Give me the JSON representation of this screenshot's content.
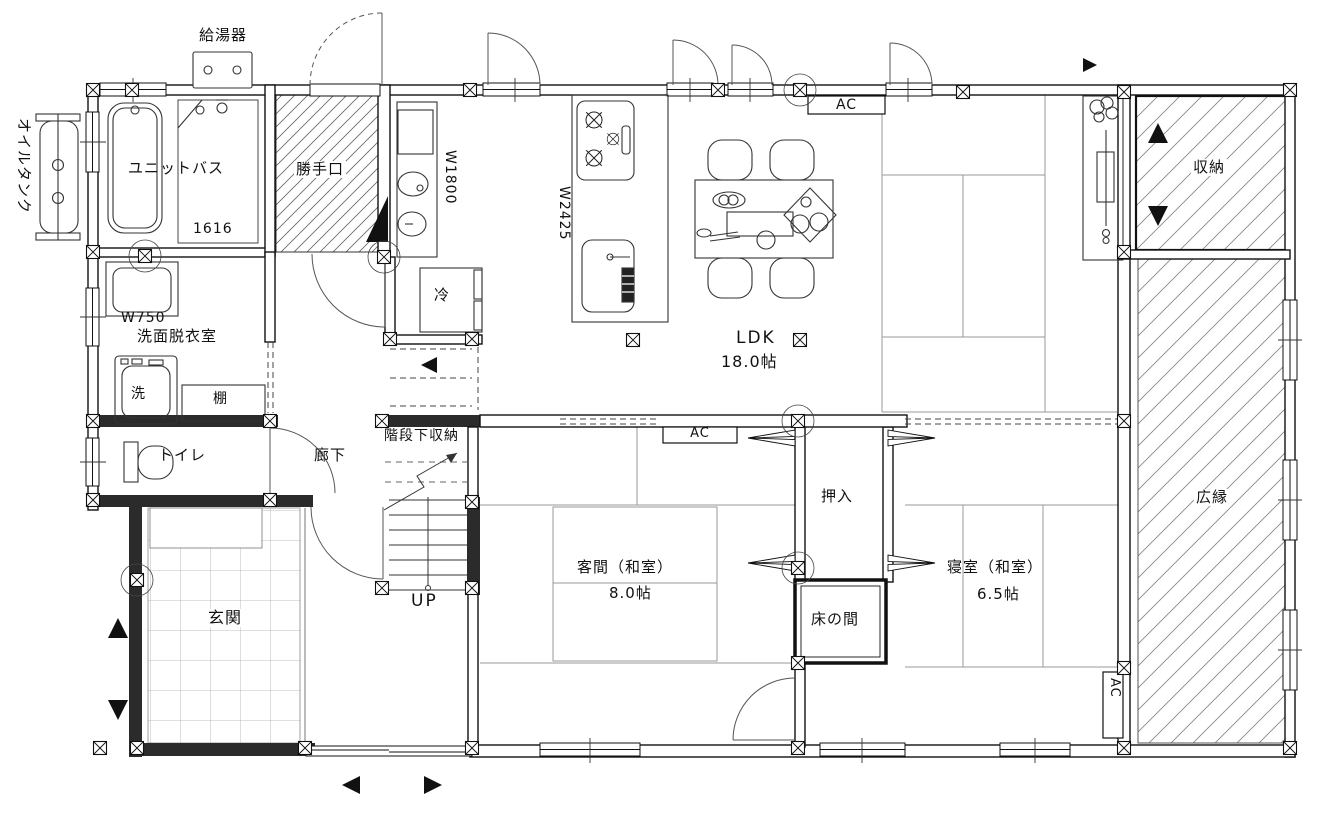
{
  "drawing": {
    "type": "architectural-floor-plan",
    "labels": {
      "oil_tank": "オイルタンク",
      "water_heater": "給湯器",
      "unit_bath": "ユニットバス",
      "unit_bath_size": "1616",
      "back_door": "勝手口",
      "vanity_width": "W1800",
      "kitchen_width": "W2425",
      "fridge": "冷",
      "washstand_width": "W750",
      "washroom": "洗面脱衣室",
      "washer": "洗",
      "shelf": "棚",
      "toilet": "トイレ",
      "corridor": "廊下",
      "under_stair_storage": "階段下収納",
      "up": "UP",
      "entrance": "玄関",
      "ldk": "LDK",
      "ldk_size": "18.0帖",
      "ac": "AC",
      "closet": "押入",
      "guest_room": "客間（和室）",
      "guest_room_size": "8.0帖",
      "tokonoma": "床の間",
      "bedroom": "寝室（和室）",
      "bedroom_size": "6.5帖",
      "storage": "収納",
      "veranda": "広縁"
    },
    "colors": {
      "line": "#1a1a1a",
      "wall_fill": "#2b2b2b",
      "floor_line": "#9a9a9a",
      "paper": "#ffffff"
    }
  }
}
